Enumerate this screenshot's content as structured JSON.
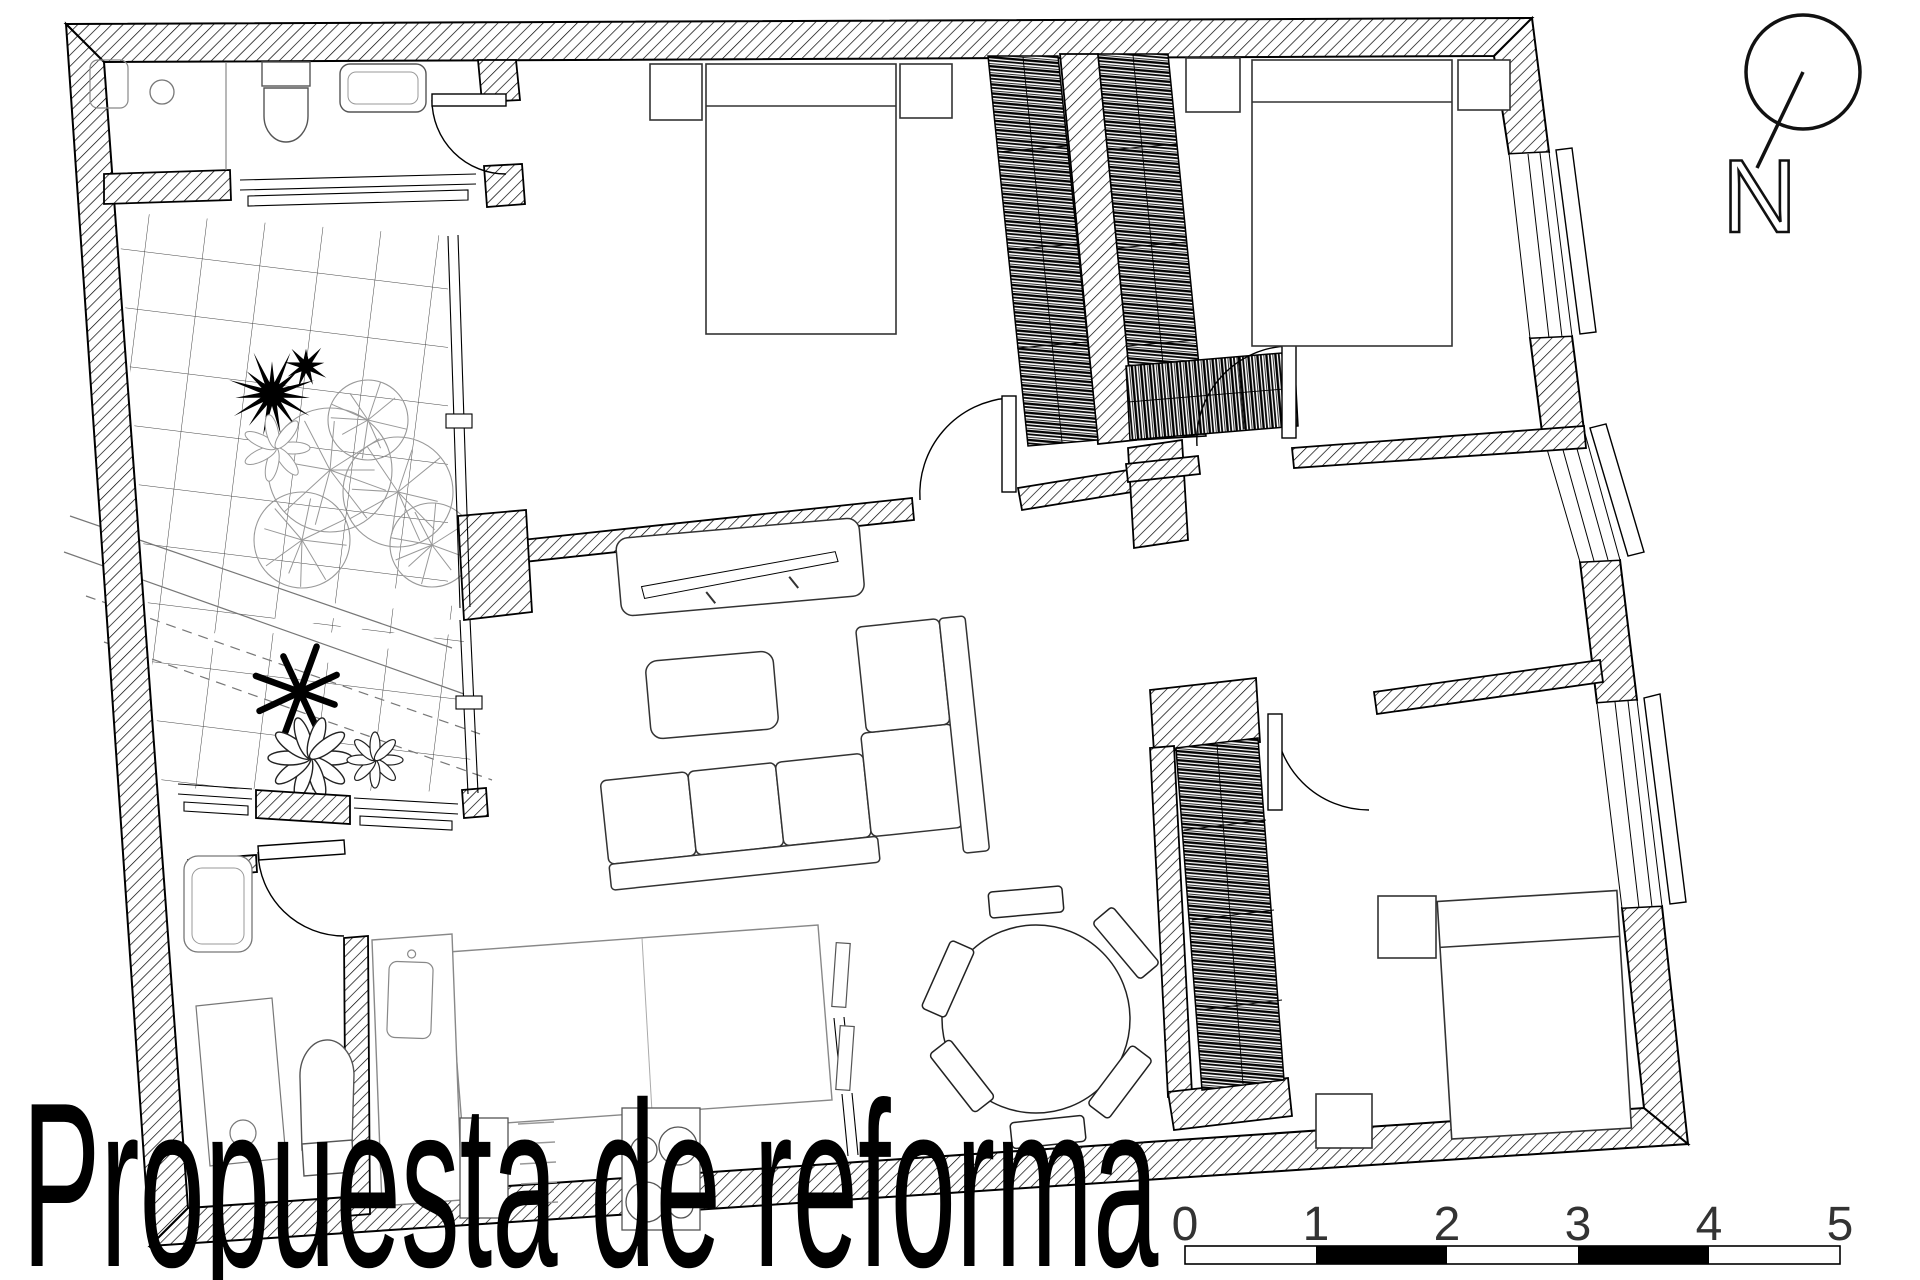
{
  "title": {
    "text": "Propuesta de reforma"
  },
  "north": {
    "label": "N"
  },
  "scalebar": {
    "labels": [
      "0",
      "1",
      "2",
      "3",
      "4",
      "5"
    ],
    "units": "meters",
    "filled_segments": [
      1,
      3
    ]
  },
  "drawing": {
    "kind": "floor-plan",
    "wall_hatch": "diagonal-lines",
    "rooms_depicted": [
      "bathroom",
      "terrace-patio",
      "bedroom",
      "bedroom",
      "hallway",
      "living-room",
      "kitchen",
      "dining-area",
      "bathroom",
      "bedroom"
    ]
  },
  "colors": {
    "ink": "#000000",
    "furniture_line": "#333333",
    "fixture_line": "#777777",
    "vegetation_line": "#999999",
    "paper": "#ffffff"
  }
}
